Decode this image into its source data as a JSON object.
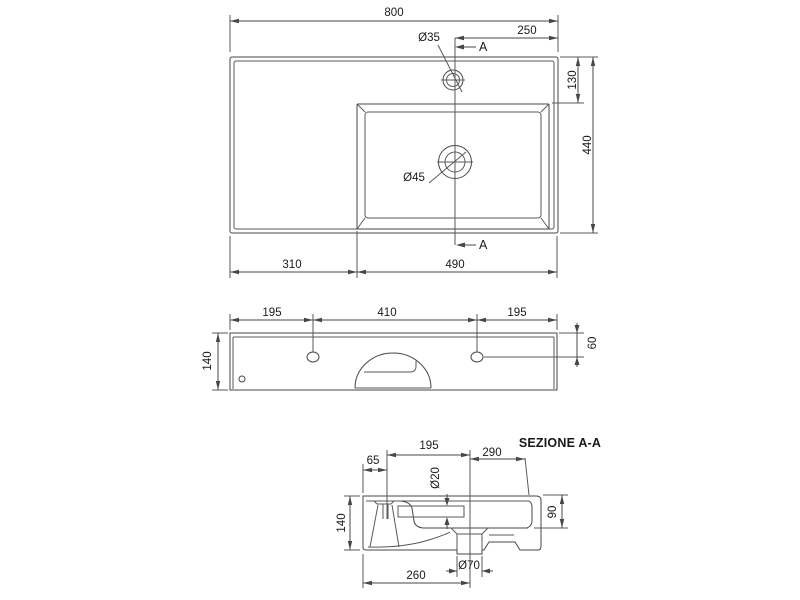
{
  "colors": {
    "line": "#474747",
    "text": "#1a1a1a",
    "background": "#ffffff"
  },
  "top_view": {
    "overall_width": "800",
    "tap_to_right": "250",
    "tap_hole_diameter": "Ø35",
    "section_marker": "A",
    "back_to_basin": "130",
    "overall_depth": "440",
    "drain_diameter": "Ø45",
    "shelf_width": "310",
    "basin_width": "490"
  },
  "front_view": {
    "height": "140",
    "left_hole_offset": "195",
    "hole_spacing": "410",
    "right_hole_offset": "195",
    "hole_drop": "60"
  },
  "section_view": {
    "label": "SEZIONE A-A",
    "wall_to_tap": "65",
    "tap_to_drain": "195",
    "drain_to_front": "290",
    "overflow_diameter": "Ø20",
    "height": "140",
    "bowl_depth": "90",
    "drain_offset": "260",
    "outlet_diameter": "Ø70"
  }
}
